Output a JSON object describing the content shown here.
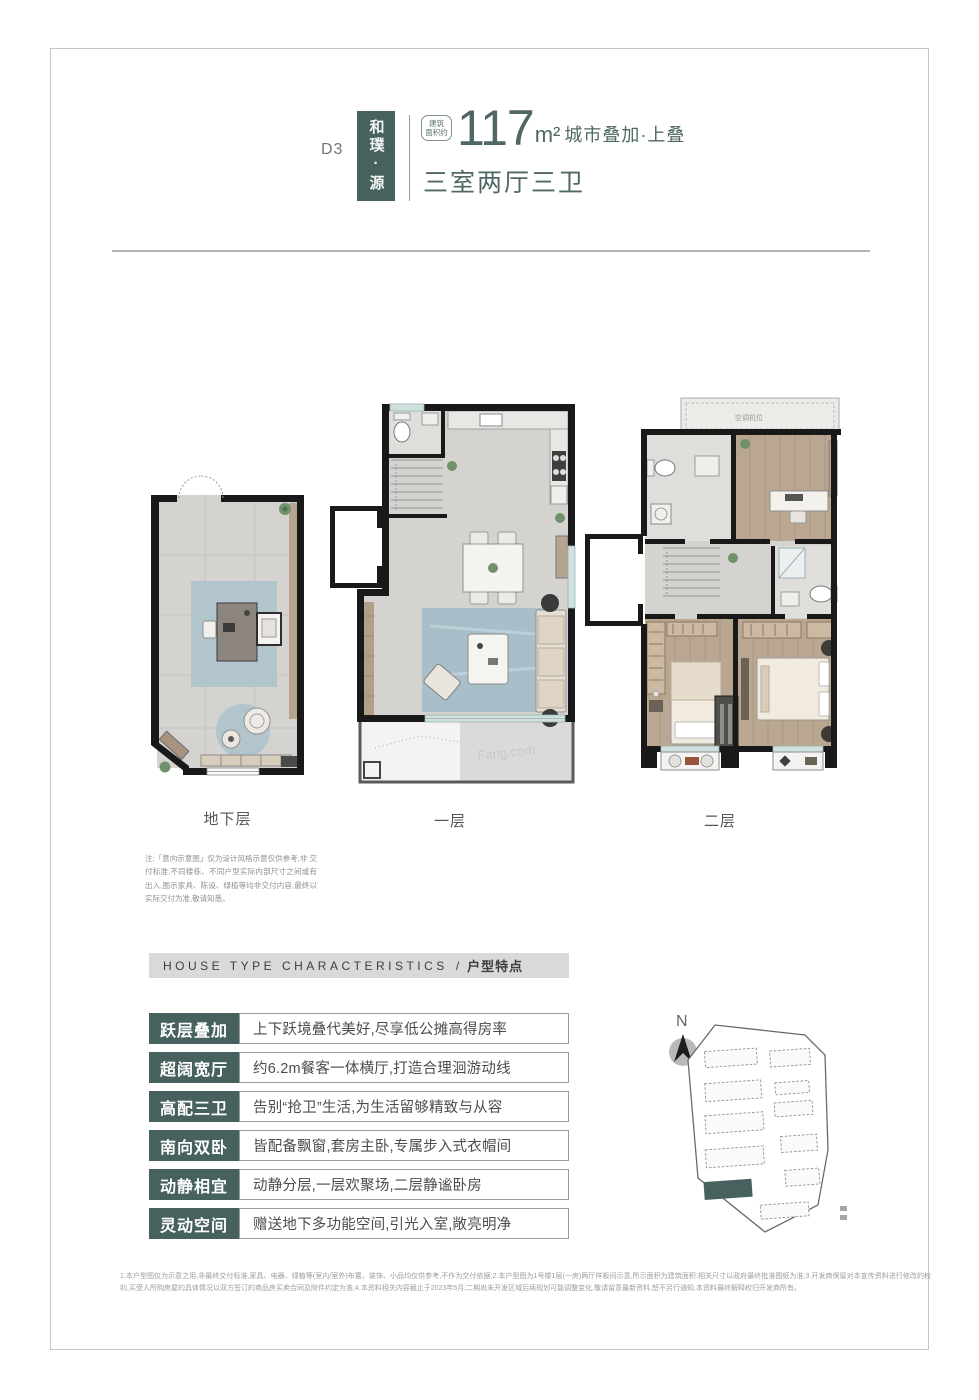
{
  "header": {
    "unit_code": "D3",
    "project_name": "和璞·源",
    "area_badge_line1": "建筑",
    "area_badge_line2": "面积约",
    "area_value": "117",
    "area_unit": "m²",
    "area_category": "城市叠加·上叠",
    "room_layout": "三室两厅三卫"
  },
  "floors": [
    {
      "label": "地下层"
    },
    {
      "label": "一层",
      "watermark": "Fang.com"
    },
    {
      "label": "二层",
      "roof_label": "空调机位"
    }
  ],
  "plan_note": "注:「意向示意图」仅为设计风格示意仅供参考,非 交付标准,不同楼栋、不同户型实际内部尺寸之间或有出入,图示家具、陈设、绿植等均非交付内容,最终以实际交付为准,敬请知悉。",
  "section_header": {
    "title_en": "HOUSE TYPE CHARACTERISTICS",
    "divider": "/",
    "title_zh": "户型特点"
  },
  "features": [
    {
      "label": "跃层叠加",
      "desc": "上下跃境叠代美好,尽享低公摊高得房率"
    },
    {
      "label": "超阔宽厅",
      "desc": "约6.2m餐客一体横厅,打造合理洄游动线"
    },
    {
      "label": "高配三卫",
      "desc": "告别“抢卫”生活,为生活留够精致与从容"
    },
    {
      "label": "南向双卧",
      "desc": "皆配备飘窗,套房主卧,专属步入式衣帽间"
    },
    {
      "label": "动静相宜",
      "desc": "动静分层,一层欢聚场,二层静谧卧房"
    },
    {
      "label": "灵动空间",
      "desc": "赠送地下多功能空间,引光入室,敞亮明净"
    }
  ],
  "site_map": {
    "north_label": "N"
  },
  "footer_note": "1.本户型图仅为示意之用,非最终交付标准,家具、电器、绿植等(室内/室外)布置、装饰、小品均仅供参考,不作为交付依据;2.本户型图为1号楼1层(一房)两厅样板间示意,所示面积为建筑面积,相关尺寸以政府最终批准图纸为准;3.开发商保留对本宣传资料进行修改的权利,买受人所购房屋的具体情况以双方签订的商品房买卖合同及附件约定为准;4.本资料相关内容截止于2023年5月,二期尚未开发区域后续规划可能调整变化,敬请留意最新资料,恕不另行通知,本资料最终解释权归开发商所有。",
  "colors": {
    "accent": "#47625e",
    "header_text": "#4f6865",
    "section_bar_bg": "#d9d9d9"
  }
}
